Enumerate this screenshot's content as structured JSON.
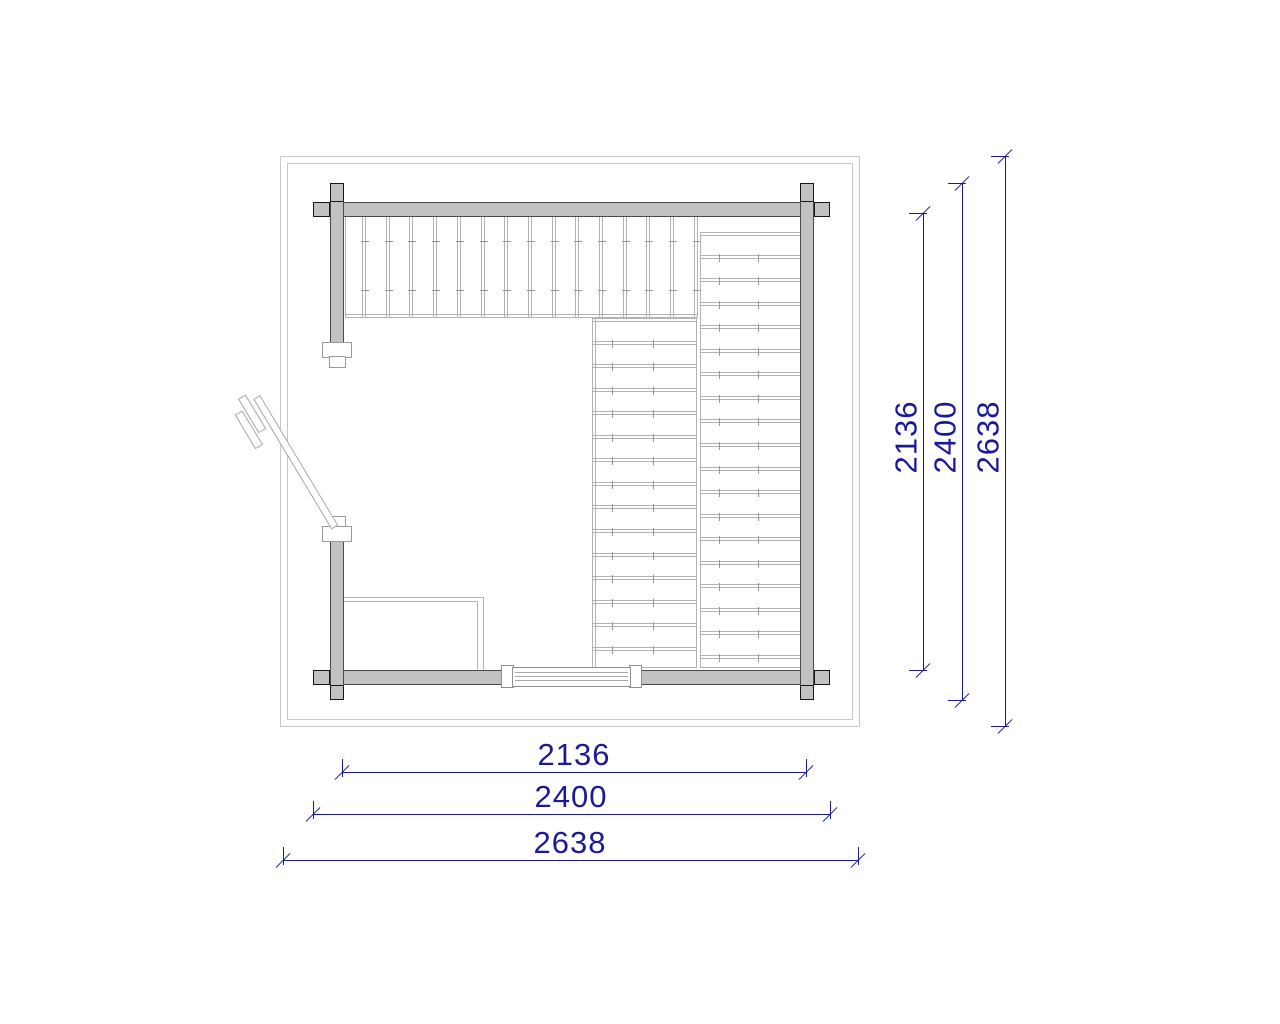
{
  "drawing": {
    "type": "log cabin / sauna floor plan",
    "units": "mm"
  },
  "dims": {
    "bottom": [
      "2136",
      "2400",
      "2638"
    ],
    "right": [
      "2136",
      "2400",
      "2638"
    ]
  },
  "plan": {
    "top_bench_dividers": 15,
    "right_bench_dividers": 18,
    "middle_deck_dividers": 14,
    "window_pane_lines": 3
  },
  "colors": {
    "dimension": "#1a1a96",
    "wall_fill": "#c2c2c2",
    "wall_outline": "#4a4a4a",
    "detail_line": "#b2b2b2"
  }
}
